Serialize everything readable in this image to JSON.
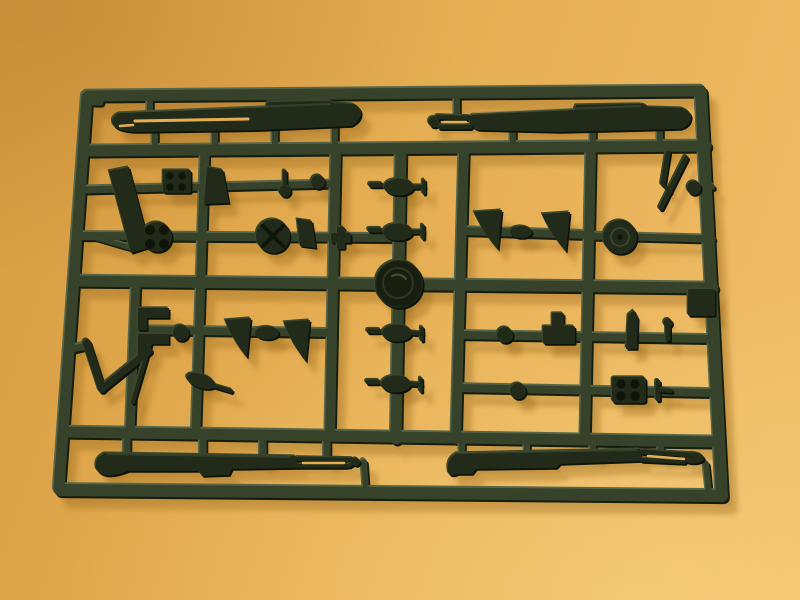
{
  "scene": {
    "type": "photograph",
    "subject": "Injection-molded plastic model kit sprue (parts tree) in dark olive-green plastic",
    "setting": "Sprue lying on an orange-tan paper surface, lit from the upper left, casting a soft warm shadow toward the lower right",
    "sprue": {
      "material_color_name": "dark olive green",
      "frame_layout": "rectangular outer frame with three internal horizontal runners, six vertical runners and short cross-rungs holding the parts",
      "large_parts": [
        "long hull/fender half, upper left",
        "long hull/fender half, upper right, with forked front end",
        "long hull/fender half, lower left, with forked tow-bar end",
        "long hull/fender half, lower right, with forked tow-bar end"
      ],
      "small_parts": [
        "round drum wheel with tiny center hole",
        "spoked wheel hub with X-shaped bolts",
        "clover-pattern wheel hub",
        "four horn/cone shaped mounts in two linked pairs",
        "studded engine-block cube",
        "four-stud mounting plate",
        "two stacked angle brackets with small wheel",
        "check-mark shaped lever and thin blade",
        "Z-shaped tow hook",
        "slanted long blade",
        "round maker's medallion boss at the central runner crossing",
        "assorted barrels with wing tabs, knobs, pins and fins"
      ],
      "approx_part_count": 40
    }
  },
  "colors": {
    "bg_a": "#d79c41",
    "bg_b": "#e6ae53",
    "bg_c": "#f0bd68",
    "shadow": "#9a6a1e",
    "rails_base": "#37422b",
    "rails_light": "#57664a",
    "rails_dark": "#161d0e",
    "parts_base": "#222b19",
    "parts_light": "#3a472d",
    "parts_dark": "#0d120a",
    "detail_dark": "#10150a",
    "detail_light": "#55644a"
  }
}
